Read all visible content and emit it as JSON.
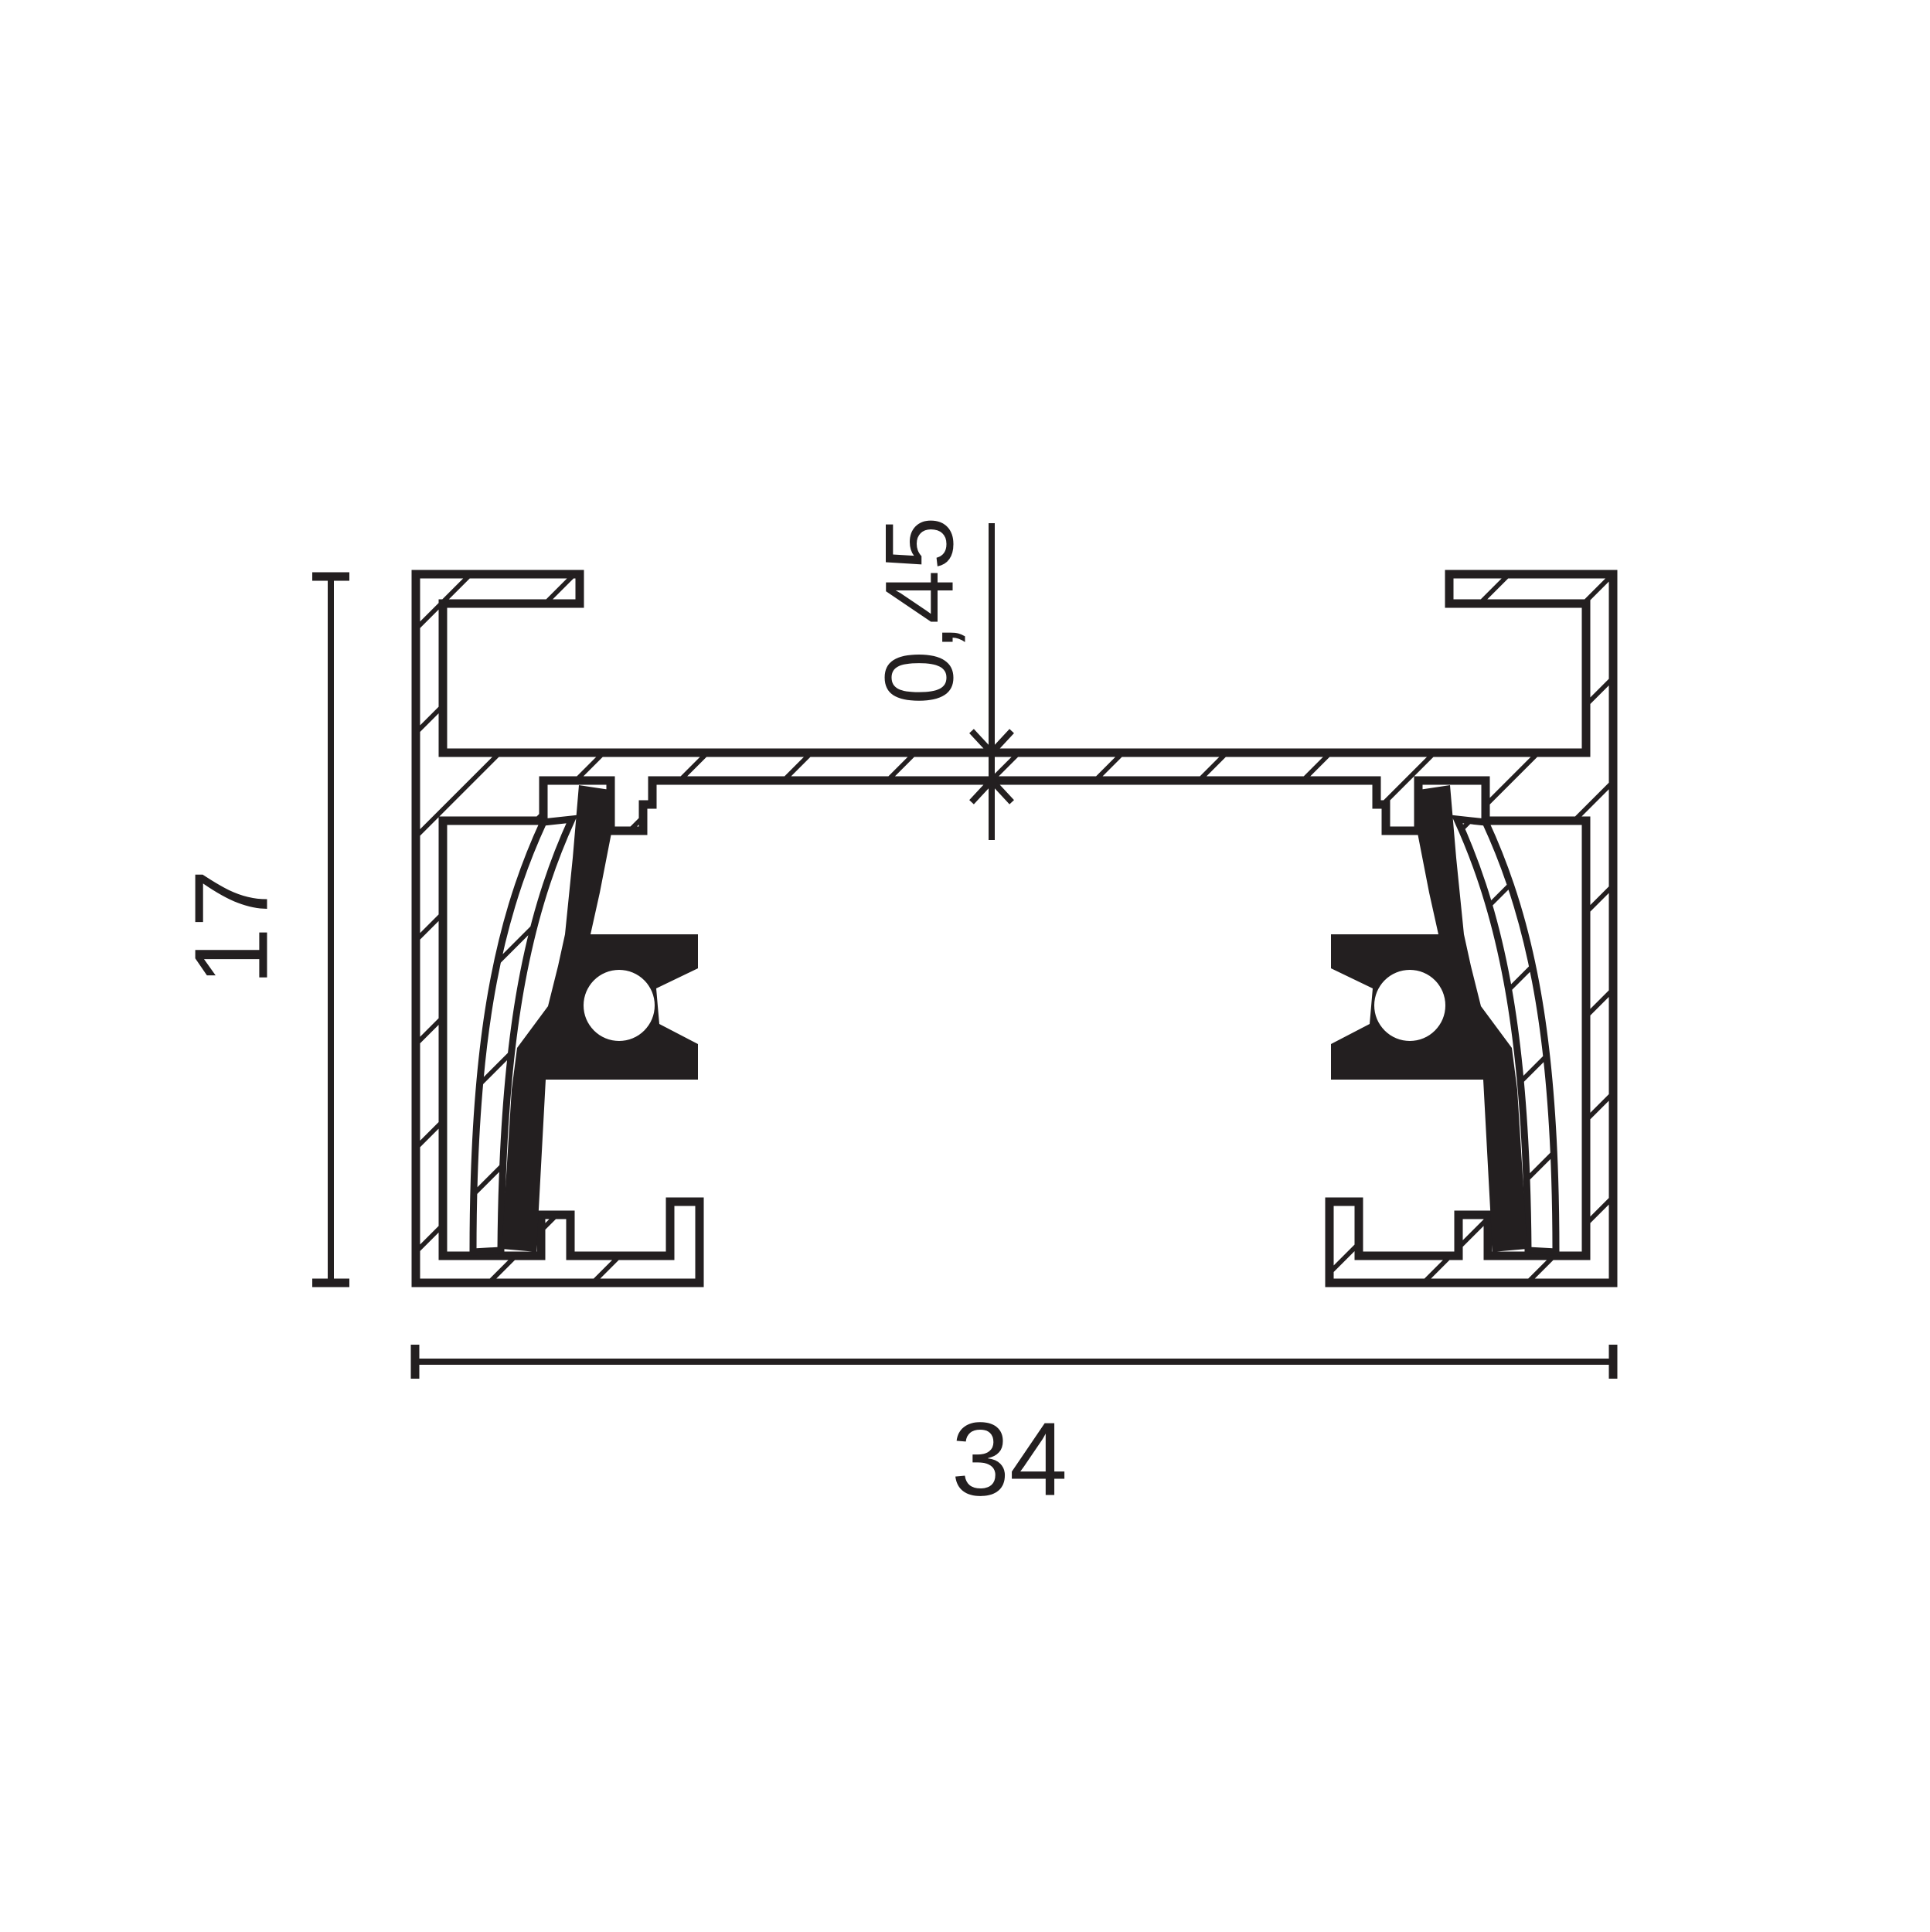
{
  "page": {
    "background": "#ffffff"
  },
  "drawing": {
    "kind": "technical-cross-section",
    "ink_color": "#231f20",
    "dimensions": {
      "height": "17",
      "width": "34",
      "plate_thickness": "0,45"
    }
  }
}
